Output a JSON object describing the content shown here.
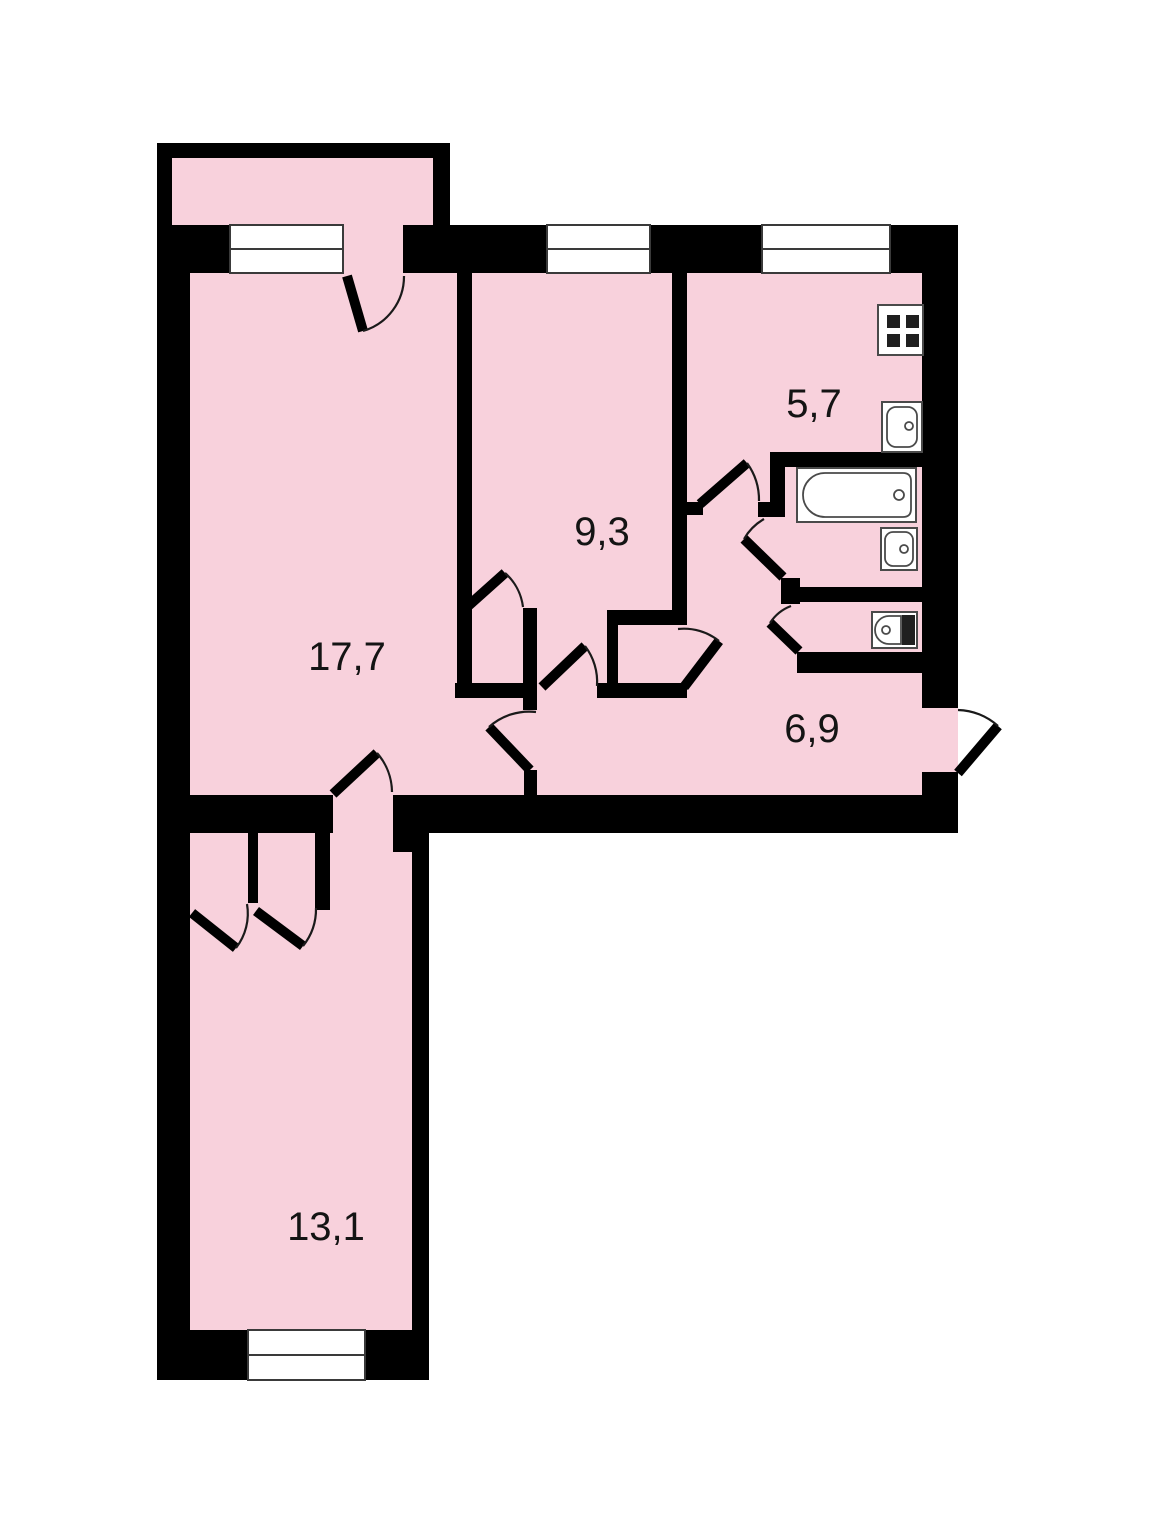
{
  "floor_plan": {
    "colors": {
      "background": "#ffffff",
      "walls": "#000000",
      "floor": "#f8d1dc",
      "fixture_fill": "#ffffff",
      "fixture_stroke": "#4a4a4a",
      "label_color": "#141414"
    },
    "rooms": [
      {
        "name": "living-room",
        "area_label": "17,7"
      },
      {
        "name": "bedroom",
        "area_label": "9,3"
      },
      {
        "name": "kitchen",
        "area_label": "5,7"
      },
      {
        "name": "hallway",
        "area_label": "6,9"
      },
      {
        "name": "second-bedroom",
        "area_label": "13,1"
      }
    ],
    "fixtures": [
      {
        "name": "stove-icon",
        "location": "kitchen"
      },
      {
        "name": "kitchen-sink-icon",
        "location": "kitchen"
      },
      {
        "name": "bathtub-icon",
        "location": "bathroom"
      },
      {
        "name": "washbasin-icon",
        "location": "bathroom"
      },
      {
        "name": "toilet-icon",
        "location": "wc"
      }
    ],
    "elements": {
      "windows": 4,
      "door_openings": 12,
      "balcony": true,
      "built_in_closets": 3
    }
  }
}
